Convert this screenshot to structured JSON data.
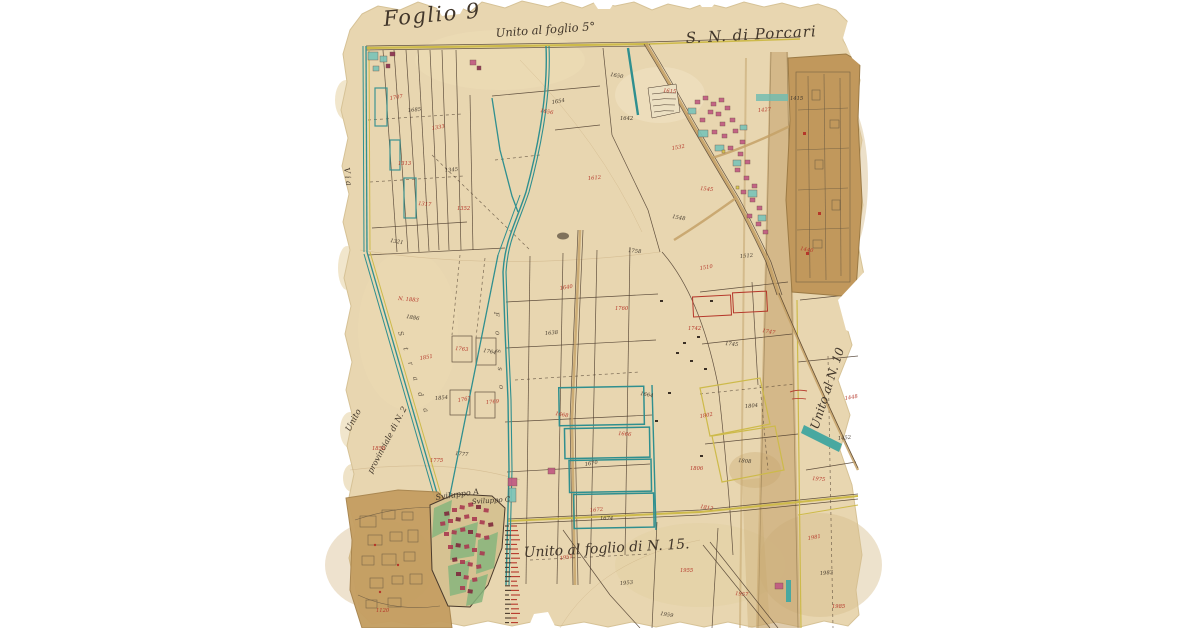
{
  "page": {
    "background": "#ffffff",
    "description": "Historical cadastral map sheet, Porcari"
  },
  "map": {
    "titles": {
      "sheet": "Foglio 9",
      "top_note": "Unito al foglio 5°",
      "section": "S. N. di Porcari",
      "bottom_note": "Unito al foglio di N. 15.",
      "right_note": "Unito al N. 10",
      "left_note_1": "Unito",
      "left_note_2": "provinciale di N. 2",
      "via": "V i a",
      "sviluppo_a": "Sviluppo A",
      "sviluppo_c": "Sviluppo C"
    },
    "road_names": {
      "canal": "F o s s o",
      "road": "S t r a d a"
    },
    "colors": {
      "paper": "#e8d6b0",
      "attached_paper": "#c59f63",
      "canal_teal": "#2f8f8f",
      "road_yellow": "#cdba4a",
      "road_tan": "#c4a167",
      "ink_black": "#42382c",
      "number_red": "#b5372a",
      "building_pink": "#c05a82",
      "garden_green": "#87b57d"
    },
    "parcel_numbers": [
      {
        "x": 390,
        "y": 100,
        "t": "1707",
        "c": "r"
      },
      {
        "x": 408,
        "y": 112,
        "t": "1685",
        "c": "b"
      },
      {
        "x": 398,
        "y": 165,
        "t": "1313",
        "c": "r"
      },
      {
        "x": 418,
        "y": 205,
        "t": "1317",
        "c": "r"
      },
      {
        "x": 390,
        "y": 242,
        "t": "1321",
        "c": "b"
      },
      {
        "x": 432,
        "y": 130,
        "t": "1333",
        "c": "r"
      },
      {
        "x": 445,
        "y": 172,
        "t": "1345",
        "c": "b"
      },
      {
        "x": 457,
        "y": 210,
        "t": "1352",
        "c": "r"
      },
      {
        "x": 398,
        "y": 300,
        "t": "N. 1883",
        "c": "r"
      },
      {
        "x": 406,
        "y": 318,
        "t": "1886",
        "c": "b"
      },
      {
        "x": 420,
        "y": 360,
        "t": "1851",
        "c": "r"
      },
      {
        "x": 435,
        "y": 400,
        "t": "1854",
        "c": "b"
      },
      {
        "x": 372,
        "y": 450,
        "t": "1858",
        "c": "r"
      },
      {
        "x": 455,
        "y": 350,
        "t": "1763",
        "c": "r"
      },
      {
        "x": 483,
        "y": 352,
        "t": "1764",
        "c": "b"
      },
      {
        "x": 458,
        "y": 402,
        "t": "1767",
        "c": "r"
      },
      {
        "x": 486,
        "y": 404,
        "t": "1769",
        "c": "r"
      },
      {
        "x": 430,
        "y": 462,
        "t": "1775",
        "c": "r"
      },
      {
        "x": 455,
        "y": 455,
        "t": "1777",
        "c": "b"
      },
      {
        "x": 540,
        "y": 112,
        "t": "1656",
        "c": "r"
      },
      {
        "x": 552,
        "y": 104,
        "t": "1654",
        "c": "b"
      },
      {
        "x": 588,
        "y": 180,
        "t": "1612",
        "c": "r"
      },
      {
        "x": 620,
        "y": 120,
        "t": "1642",
        "c": "b"
      },
      {
        "x": 663,
        "y": 92,
        "t": "1615",
        "c": "r"
      },
      {
        "x": 610,
        "y": 76,
        "t": "1650",
        "c": "b"
      },
      {
        "x": 560,
        "y": 290,
        "t": "1640",
        "c": "r"
      },
      {
        "x": 545,
        "y": 335,
        "t": "1638",
        "c": "b"
      },
      {
        "x": 615,
        "y": 310,
        "t": "1760",
        "c": "r"
      },
      {
        "x": 628,
        "y": 252,
        "t": "1758",
        "c": "b"
      },
      {
        "x": 555,
        "y": 415,
        "t": "1668",
        "c": "r"
      },
      {
        "x": 585,
        "y": 466,
        "t": "1670",
        "c": "b"
      },
      {
        "x": 590,
        "y": 512,
        "t": "1672",
        "c": "r"
      },
      {
        "x": 600,
        "y": 520,
        "t": "1674",
        "c": "b"
      },
      {
        "x": 618,
        "y": 435,
        "t": "1666",
        "c": "r"
      },
      {
        "x": 640,
        "y": 395,
        "t": "1664",
        "c": "b"
      },
      {
        "x": 700,
        "y": 270,
        "t": "1510",
        "c": "r"
      },
      {
        "x": 740,
        "y": 258,
        "t": "1512",
        "c": "b"
      },
      {
        "x": 688,
        "y": 330,
        "t": "1742",
        "c": "r"
      },
      {
        "x": 725,
        "y": 345,
        "t": "1745",
        "c": "b"
      },
      {
        "x": 762,
        "y": 332,
        "t": "1747",
        "c": "r"
      },
      {
        "x": 700,
        "y": 418,
        "t": "1802",
        "c": "r"
      },
      {
        "x": 745,
        "y": 408,
        "t": "1804",
        "c": "b"
      },
      {
        "x": 690,
        "y": 470,
        "t": "1806",
        "c": "r"
      },
      {
        "x": 738,
        "y": 462,
        "t": "1808",
        "c": "b"
      },
      {
        "x": 700,
        "y": 508,
        "t": "1812",
        "c": "r"
      },
      {
        "x": 672,
        "y": 150,
        "t": "1532",
        "c": "r"
      },
      {
        "x": 758,
        "y": 112,
        "t": "1427",
        "c": "r"
      },
      {
        "x": 790,
        "y": 100,
        "t": "1415",
        "c": "b"
      },
      {
        "x": 700,
        "y": 190,
        "t": "1545",
        "c": "r"
      },
      {
        "x": 672,
        "y": 218,
        "t": "1548",
        "c": "b"
      },
      {
        "x": 560,
        "y": 560,
        "t": "1951",
        "c": "r"
      },
      {
        "x": 620,
        "y": 585,
        "t": "1953",
        "c": "b"
      },
      {
        "x": 680,
        "y": 572,
        "t": "1955",
        "c": "r"
      },
      {
        "x": 735,
        "y": 595,
        "t": "1957",
        "c": "r"
      },
      {
        "x": 660,
        "y": 615,
        "t": "1959",
        "c": "b"
      },
      {
        "x": 808,
        "y": 540,
        "t": "1981",
        "c": "r"
      },
      {
        "x": 820,
        "y": 575,
        "t": "1983",
        "c": "b"
      },
      {
        "x": 832,
        "y": 608,
        "t": "1985",
        "c": "r"
      },
      {
        "x": 812,
        "y": 480,
        "t": "1975",
        "c": "r"
      },
      {
        "x": 800,
        "y": 250,
        "t": "1440",
        "c": "r"
      },
      {
        "x": 845,
        "y": 400,
        "t": "1448",
        "c": "r"
      },
      {
        "x": 838,
        "y": 440,
        "t": "1452",
        "c": "b"
      },
      {
        "x": 376,
        "y": 612,
        "t": "1120",
        "c": "r"
      }
    ]
  }
}
